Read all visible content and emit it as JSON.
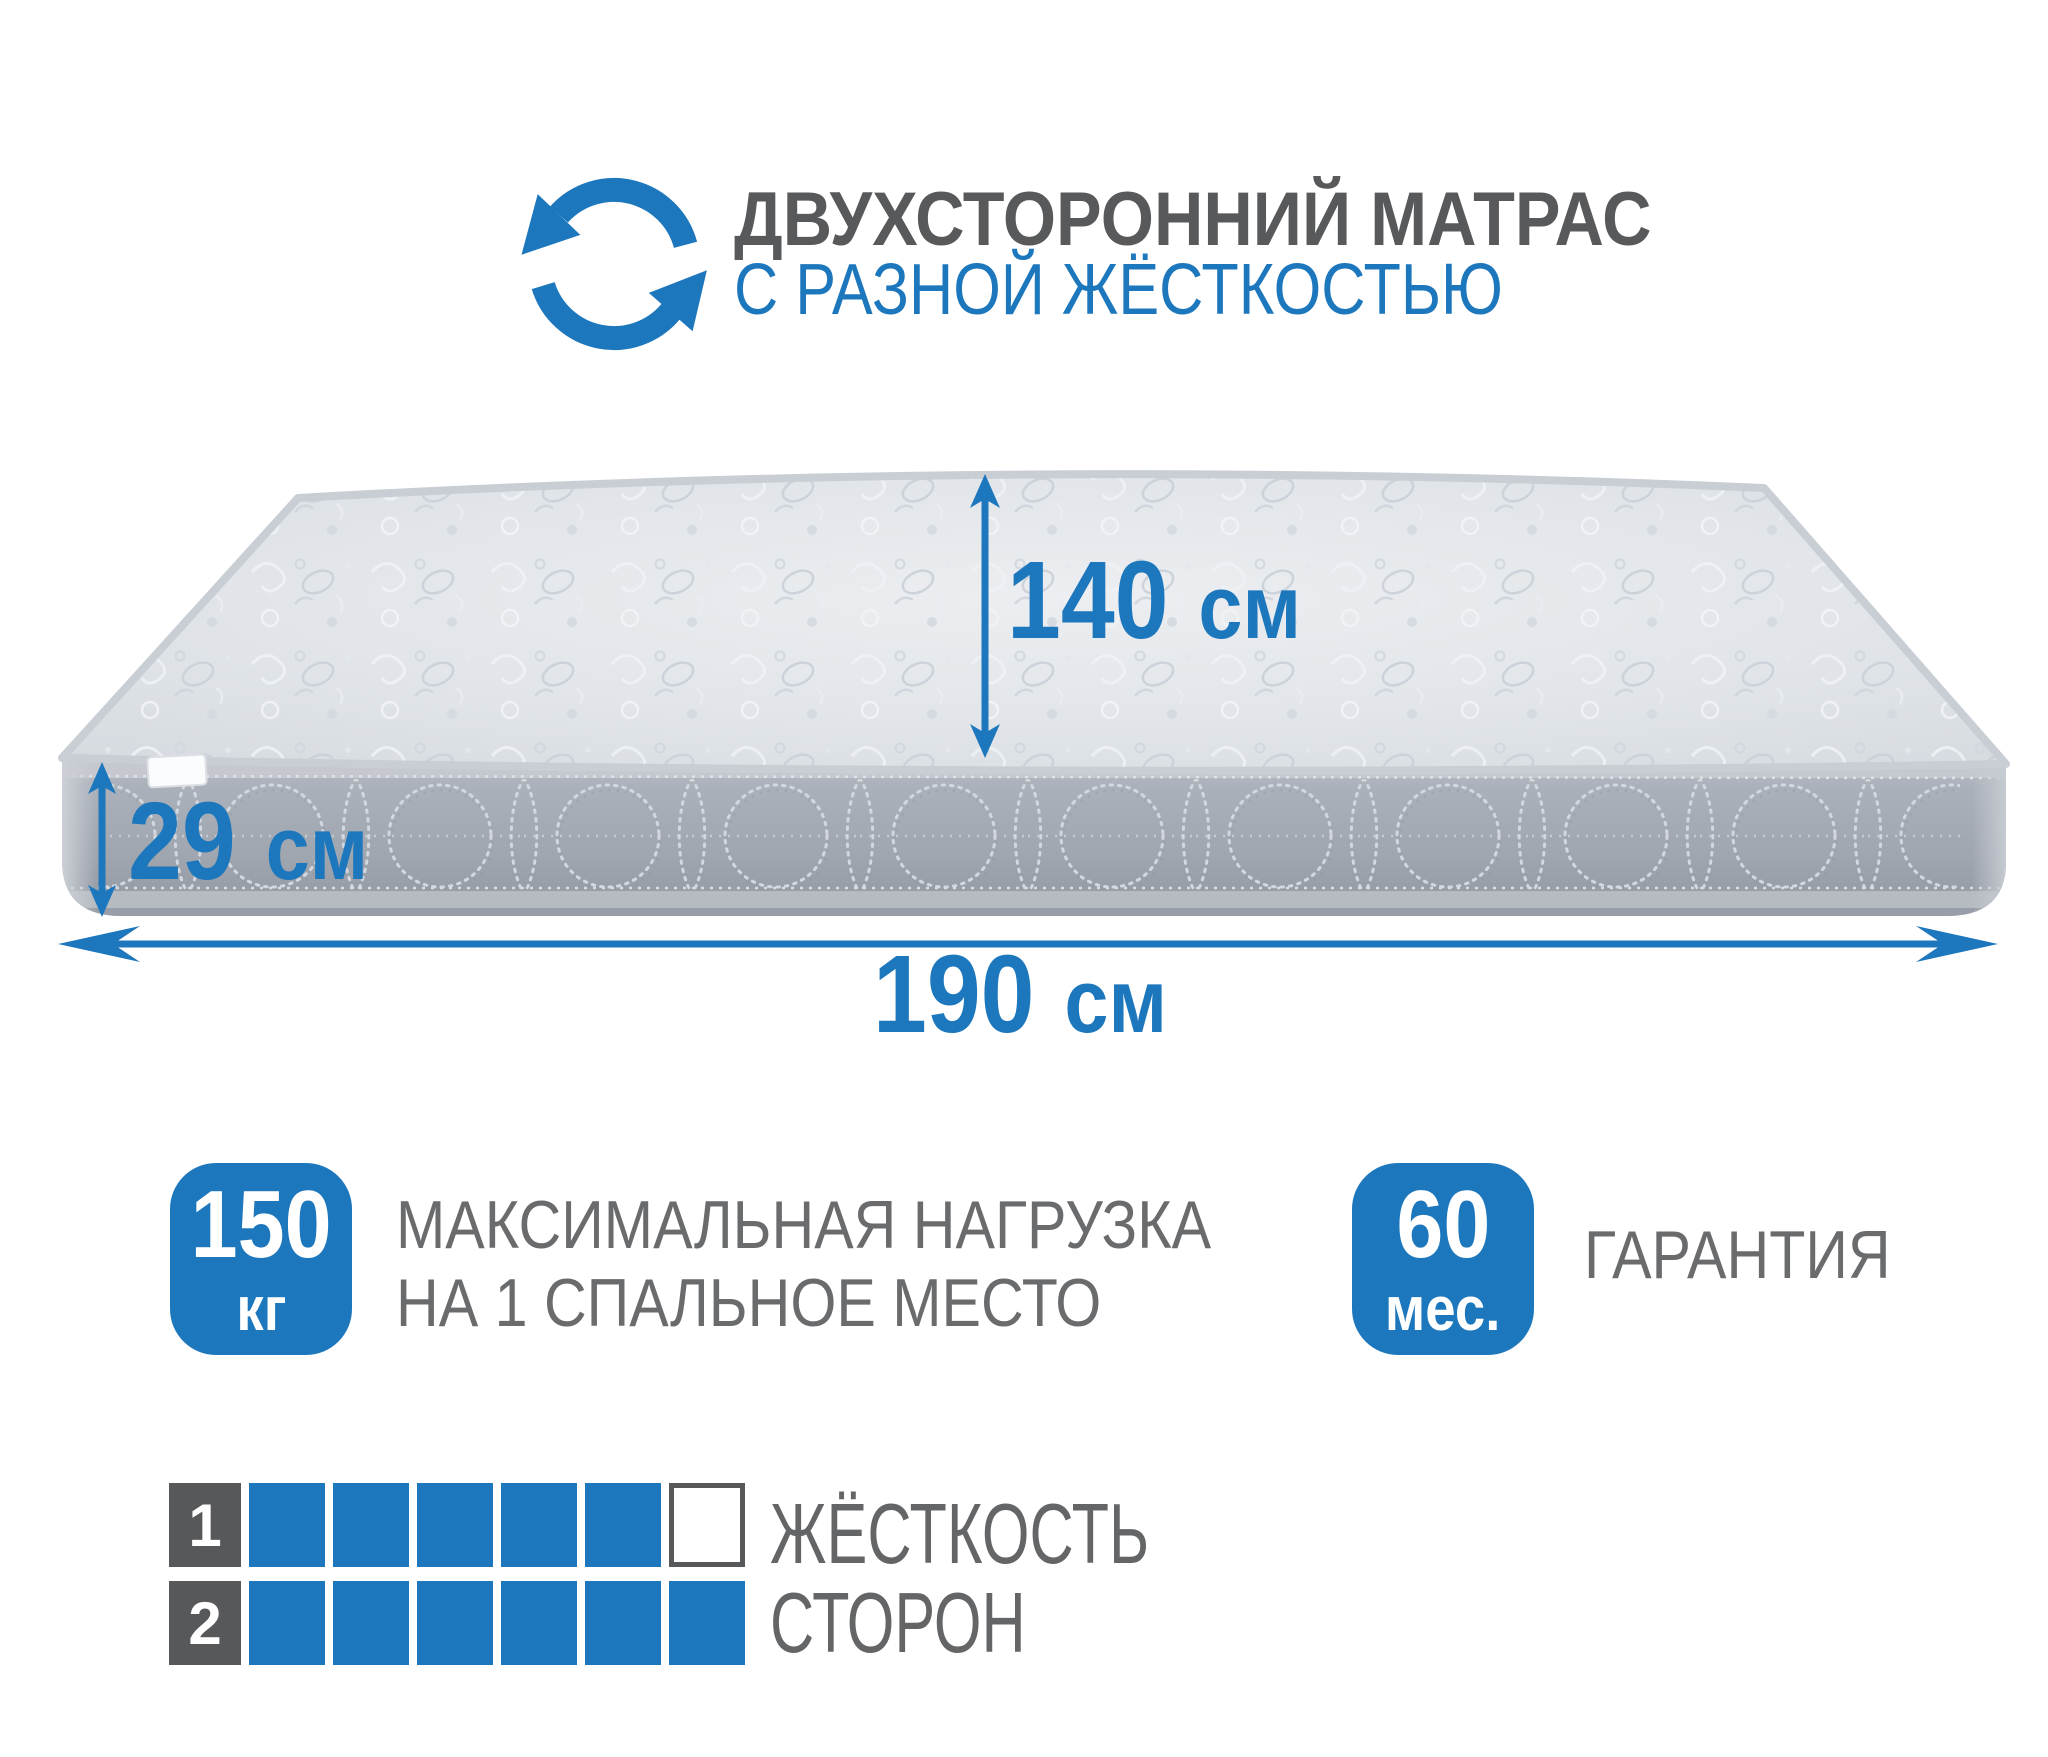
{
  "colors": {
    "accent": "#1d77bd",
    "dark_text": "#58595b",
    "gray_text": "#6a6b6d",
    "mattress_top": "#dde1e6",
    "mattress_side": "#a0a6af"
  },
  "header": {
    "icon_name": "rotation-arrows",
    "title": "ДВУХСТОРОННИЙ МАТРАС",
    "subtitle": "С РАЗНОЙ ЖЁСТКОСТЬЮ"
  },
  "dimensions": {
    "width": {
      "value": "140",
      "unit": "см"
    },
    "height": {
      "value": "29",
      "unit": "см"
    },
    "length": {
      "value": "190",
      "unit": "см"
    }
  },
  "features": {
    "max_load": {
      "value": "150",
      "unit": "кг",
      "label_line1": "МАКСИМАЛЬНАЯ НАГРУЗКА",
      "label_line2": "НА 1 СПАЛЬНОЕ МЕСТО"
    },
    "warranty": {
      "value": "60",
      "unit": "мес.",
      "label": "ГАРАНТИЯ"
    }
  },
  "firmness": {
    "label_line1": "ЖЁСТКОСТЬ",
    "label_line2": "СТОРОН",
    "rows": [
      {
        "index": "1",
        "filled": 5,
        "total": 6
      },
      {
        "index": "2",
        "filled": 6,
        "total": 6
      }
    ]
  }
}
